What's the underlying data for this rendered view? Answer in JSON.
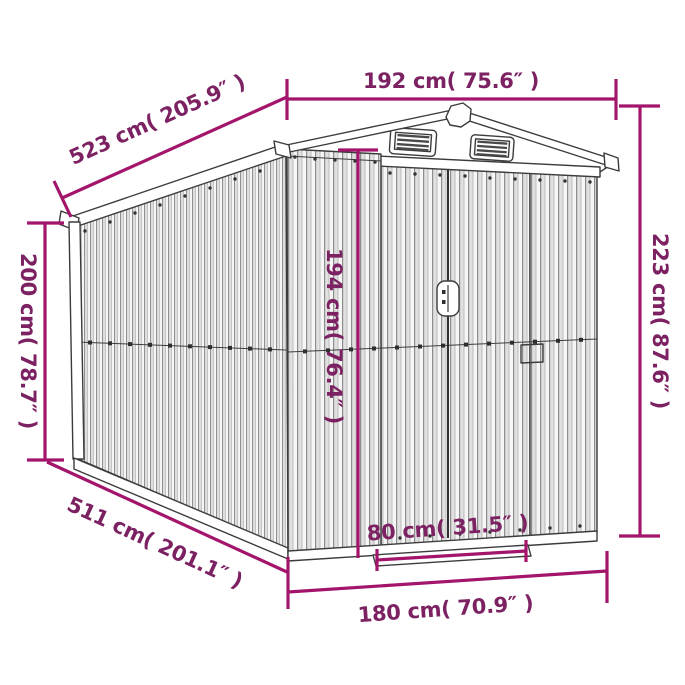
{
  "diagram": {
    "type": "product-dimension-diagram",
    "subject": "metal garden shed with gable roof, two gable vents and double sliding doors",
    "colors": {
      "background": "#ffffff",
      "dimension_line": "#A3146B",
      "dimension_text": "#7C2162",
      "drawing_outline": "#3c3c3c"
    },
    "dimensions": {
      "roof_width_top": "192 cm( 75.6″ )",
      "roof_depth_top": "523 cm( 205.9″ )",
      "wall_height_left": "200 cm( 78.7″ )",
      "door_height": "194 cm( 76.4″ )",
      "total_height_right": "223 cm( 87.6″ )",
      "door_opening_width": "80 cm( 31.5″ )",
      "base_width_front": "180 cm( 70.9″ )",
      "base_depth_bottom": "511 cm( 201.1″ )"
    }
  }
}
